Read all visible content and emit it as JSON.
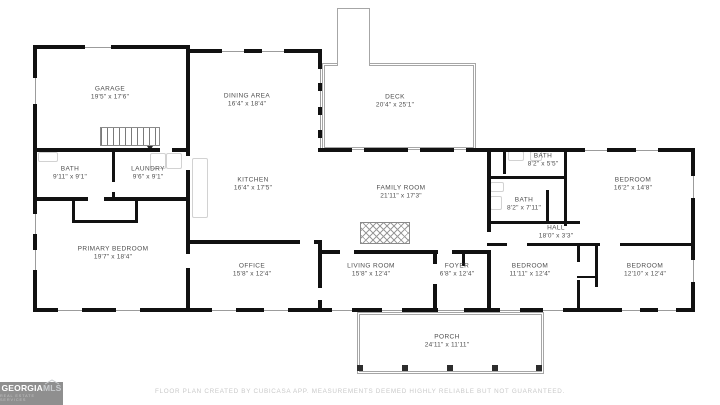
{
  "rooms": [
    {
      "name": "GARAGE",
      "dims": "19'5\" x 17'6\""
    },
    {
      "name": "DINING AREA",
      "dims": "16'4\" x 18'4\""
    },
    {
      "name": "DECK",
      "dims": "20'4\" x 25'1\""
    },
    {
      "name": "BATH",
      "dims": "9'11\" x 9'1\""
    },
    {
      "name": "LAUNDRY",
      "dims": "9'6\" x 9'1\""
    },
    {
      "name": "KITCHEN",
      "dims": "16'4\" x 17'5\""
    },
    {
      "name": "FAMILY ROOM",
      "dims": "21'11\" x 17'3\""
    },
    {
      "name": "BATH",
      "dims": "8'2\" x 5'5\""
    },
    {
      "name": "BEDROOM",
      "dims": "16'2\" x 14'8\""
    },
    {
      "name": "BATH",
      "dims": "8'2\" x 7'11\""
    },
    {
      "name": "HALL",
      "dims": "18'0\" x 3'3\""
    },
    {
      "name": "PRIMARY BEDROOM",
      "dims": "19'7\" x 18'4\""
    },
    {
      "name": "OFFICE",
      "dims": "15'8\" x 12'4\""
    },
    {
      "name": "LIVING ROOM",
      "dims": "15'8\" x 12'4\""
    },
    {
      "name": "FOYER",
      "dims": "6'8\" x 12'4\""
    },
    {
      "name": "BEDROOM",
      "dims": "11'11\" x 12'4\""
    },
    {
      "name": "BEDROOM",
      "dims": "12'10\" x 12'4\""
    },
    {
      "name": "PORCH",
      "dims": "24'11\" x 11'11\""
    }
  ],
  "footer": {
    "disclaimer": "FLOOR PLAN CREATED BY CUBICASA APP. MEASUREMENTS DEEMED HIGHLY RELIABLE BUT NOT GUARANTEED."
  },
  "logo": {
    "name": "GEORGIA",
    "suffix": "MLS",
    "tagline": "REAL ESTATE SERVICES"
  },
  "colors": {
    "wall": "#111111",
    "deck_porch_outline": "#a6a6a6",
    "room_label": "#4e4e4e",
    "disclaimer_text": "#c9c9c9",
    "logo_background": "#8f8f8f"
  }
}
